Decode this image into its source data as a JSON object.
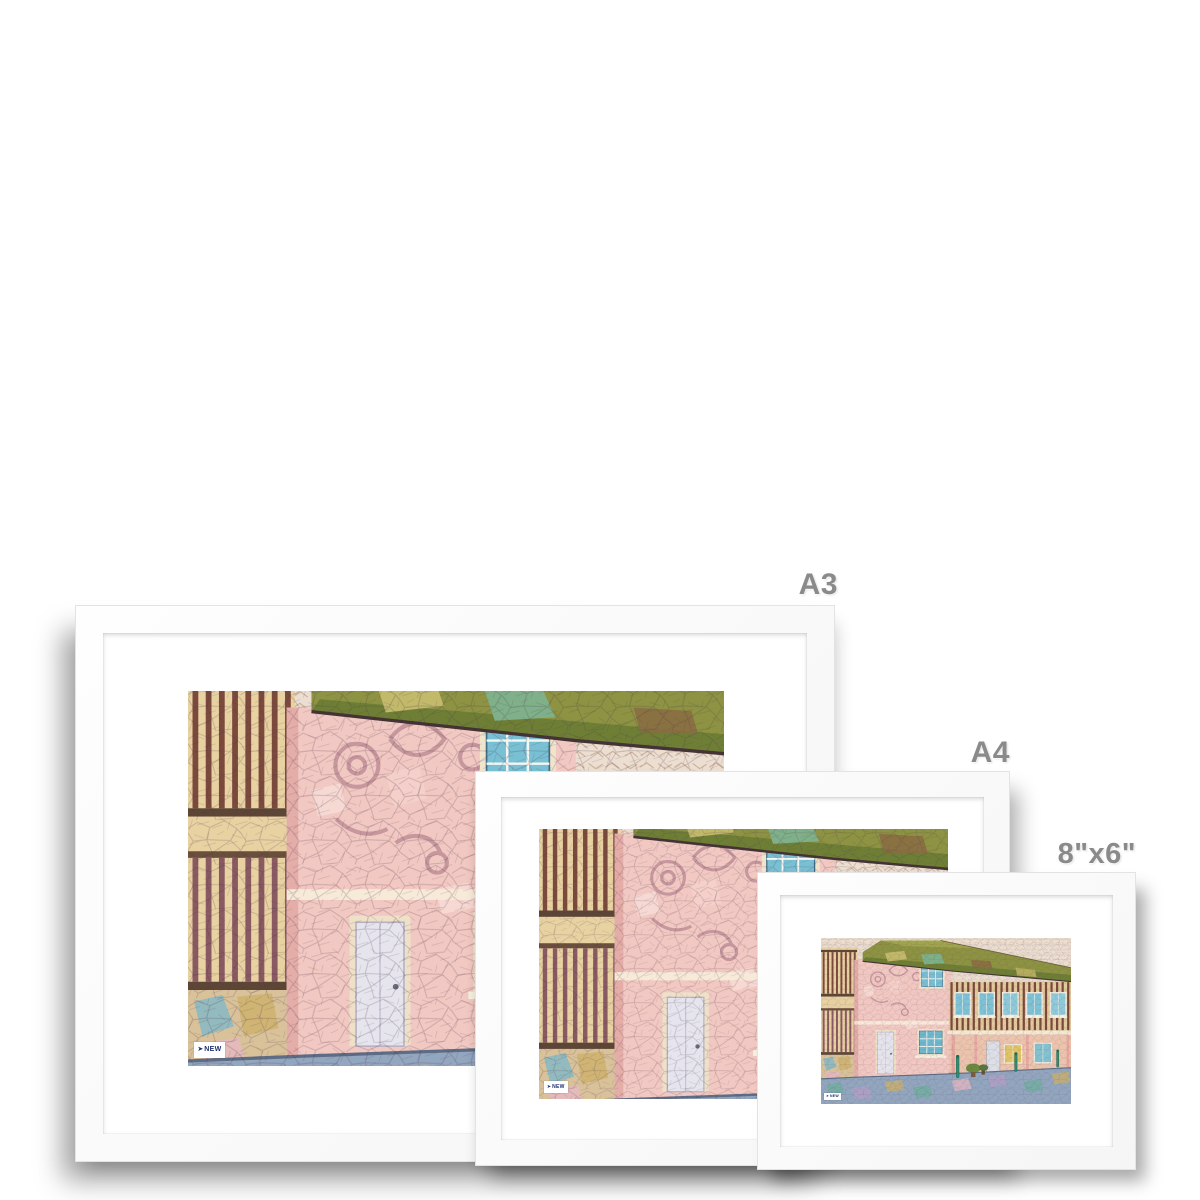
{
  "mockup": {
    "description": "Framed art print size comparison mockup, three white frames with white mats on a white background",
    "background": "#ffffff",
    "frame_color": "#fbfbfb",
    "mat_color": "#ffffff"
  },
  "size_labels": [
    {
      "id": "a3",
      "text": "A3"
    },
    {
      "id": "a4",
      "text": "A4"
    },
    {
      "id": "s86",
      "text": "8\"x6\""
    }
  ],
  "label_color": "#8a8a8a",
  "watermark": {
    "text": "NEW",
    "color": "#1d2e6e",
    "background": "#ffffff"
  },
  "artwork": {
    "subject": "Mosaic stained-glass style illustration of medieval timber-framed houses on a street",
    "palette": {
      "sky": "#ecdfd2",
      "sky_crackle": "#c4a188",
      "roof_green": "#8d9342",
      "roof_dark_green": "#6e7f35",
      "roof_light": "#c2b96a",
      "timber": "#7c4a3c",
      "plaster_cream": "#e9d2a2",
      "plaster_pink": "#f2c8c2",
      "pargeting": "#c08f98",
      "window_teal": "#79c0d4",
      "window_gold": "#e2c569",
      "door_pale": "#e6e5ee",
      "street_blue": "#93a6bf",
      "bollard_teal": "#2e8f72",
      "outline": "#4a3548"
    }
  }
}
